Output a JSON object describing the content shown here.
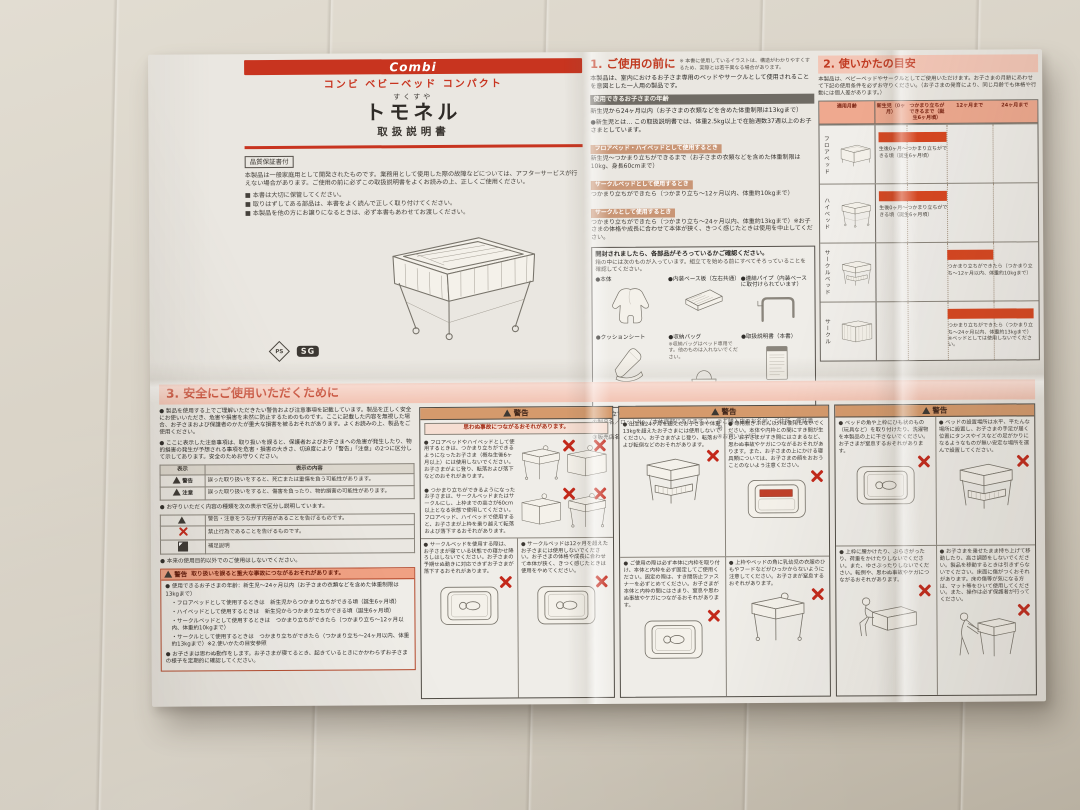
{
  "colors": {
    "brand_red": "#c8341f",
    "header_band_pink": "#f3c6b6",
    "timeline_bar_orange": "#d8451f",
    "warning_band_tan": "#d59a6c",
    "prohibited_x_red": "#c3281a",
    "paper": "#eae7e1",
    "background_sofa": "#cfc8bb"
  },
  "icons": {
    "ps_mark": "PS",
    "sg_mark": "SG",
    "warning_triangle": "△",
    "prohibited_x": "✕",
    "supplement_mark": "■"
  },
  "masthead": {
    "brand": "Combi",
    "product_line": "コンビ ベビーベッド コンパクト",
    "reading": "すくすや",
    "product_name": "トモネル",
    "doc_type": "取扱説明書",
    "warranty_badge": "品質保証書付",
    "intro": "本製品は一般家庭用として開発されたものです。業務用として使用した際の故障などについては、アフターサービスが行えない場合があります。ご使用の前に必ずこの取扱説明書をよくお読みの上、正しくご使用ください。",
    "notes": [
      "■ 本書は大切に保管してください。",
      "■ 取りはずしてある部品は、本書をよく読んで正しく取り付けてください。",
      "■ 本製品を他の方にお譲りになるときは、必ず本書もあわせてお渡しください。"
    ],
    "marks": {
      "ps": "PS",
      "sg": "SG"
    }
  },
  "section1": {
    "title": "1. ご使用の前に",
    "title_note": "※ 本書に使用しているイラストは、構造がわかりやすくするため、実際とは若干異なる場合があります。",
    "intro": "本製品は、室内におけるお子さま専用のベッドやサークルとして使用されることを意図とした一人用の製品です。",
    "age_heading": "使用できるお子さまの年齢",
    "age_line1": "新生児から24ヶ月以内（お子さまの衣類などを含めた体重制限は13kgまで）",
    "age_line2": "●新生児とは… この取扱説明書では、体重2.5kg以上で在胎週数37週以上のお子さまとしています。",
    "modes": [
      {
        "band": "フロアベッド・ハイベッドとして使用するとき",
        "text": "新生児～つかまり立ちができるまで（お子さまの衣類などを含めた体重制限は10kg、身長60cmまで）"
      },
      {
        "band": "サークルベッドとして使用するとき",
        "text": "つかまり立ちができたら（つかまり立ち～12ヶ月以内、体重約10kgまで）"
      },
      {
        "band": "サークルとして使用するとき",
        "text": "つかまり立ちができたら（つかまり立ち～24ヶ月以内、体重約13kgまで）※お子さまの体格や成長に合わせて本体が狭く、きつく感じたときは使用を中止してください。"
      }
    ],
    "parts_box": {
      "title": "開封されましたら、各部品がそろっているかご確認ください。",
      "subtitle": "箱の中には次のものが入っています。組立てを始める前にすべてそろっていることを確認してください。",
      "parts": [
        {
          "name": "●本体"
        },
        {
          "name": "●内装ベース板（左右共通）"
        },
        {
          "name": "●連結パイプ（内装ベースに取付けられています）"
        },
        {
          "name": "●クッションシート"
        },
        {
          "name": "●収納バッグ",
          "note": "※収納バッグはベッド専用です。他のものは入れないでください。"
        },
        {
          "name": "●取扱説明書（本書）"
        }
      ]
    },
    "warranty_note": "● 組み立てる前に、「品質保証書」に次の項目を記入してください。",
    "warranty_items": [
      "①製品名／ロットNo.（本体底部にあります。）",
      "②ご購入店のお名前・ご住所・電話番号",
      "③販売店名",
      "④お買い上げ日"
    ]
  },
  "section2": {
    "title": "2. 使いかたの目安",
    "intro": "本製品は、ベビーベッドやサークルとしてご使用いただけます。お子さまの月齢にあわせて下記の使用条件を必ずお守りください。（お子さまの発育により、同じ月齢でも体格や行動には個人差があります。）",
    "table": {
      "label_header": "適用月齢",
      "columns": [
        "新生児（0ヶ月）",
        "つかまり立ちができるまで（誕生6ヶ月頃）",
        "12ヶ月まで",
        "24ヶ月まで"
      ],
      "rows": [
        {
          "mode": "フロアベッド",
          "range": "生後0ヶ月～つかまり立ちができる頃（誕生6ヶ月頃）"
        },
        {
          "mode": "ハイベッド",
          "range": "生後0ヶ月～つかまり立ちができる頃（誕生6ヶ月頃）"
        },
        {
          "mode": "サークルベッド",
          "range": "つかまり立ちができたら（つかまり立ち～12ヶ月以内、体重約10kgまで）"
        },
        {
          "mode": "サークル",
          "range": "つかまり立ちができたら（つかまり立ち～24ヶ月以内、体重約13kgまで）※ベッドとしては使用しないでください。"
        }
      ]
    }
  },
  "section3": {
    "title": "3. 安全にご使用いただくために",
    "intro1": "● 製品を使用する上でご理解いただきたい警告および注意事項を記載しています。製品を正しく安全にお使いいただき、危害や損害を未然に防止するためのものです。ここに記載した内容を無視した場合、お子さまおよび保護者のかたが重大な損害を被るおそれがあります。よくお読みの上、製品をご使用ください。",
    "intro2": "● ここに表示した注意事項は、取り扱いを誤ると、保護者およびお子さまへの危害が発生したり、物的損害の発生が予想される事項を危害・損害の大きさ、切迫度により「警告」「注意」の2つに区分して示してあります。安全のためお守りください。",
    "label_table": {
      "col1": "表示",
      "col2": "表示の内容",
      "rows": [
        {
          "label": "警告",
          "text": "誤った取り扱いをすると、死亡または重傷を負う可能性があります。"
        },
        {
          "label": "注意",
          "text": "誤った取り扱いをすると、傷害を負ったり、物的損害の可能性があります。"
        }
      ]
    },
    "symbol_note": "● お守りいただく内容の種類を次の表示で区分し説明しています。",
    "symbols": [
      {
        "text": "警告・注意をうながす内容があることを告げるものです。"
      },
      {
        "text": "禁止行為であることを告げるものです。"
      },
      {
        "text": "補足説明"
      }
    ],
    "purpose_note": "● 本来の使用目的以外でのご使用はしないでください。",
    "warn_box": {
      "label": "警告",
      "head": "取り扱いを誤ると重大な事故につながるおそれがあります。",
      "item1": "● 使用できるお子さまの年齢：新生児～24ヶ月以内（お子さまの衣類などを含めた体重制限は13kgまで）",
      "sub": [
        "・フロアベッドとして使用するときは　新生児からつかまり立ちができる頃（誕生6ヶ月頃）",
        "・ハイベッドとして使用するときは　新生児からつかまり立ちができる頃（誕生6ヶ月頃）",
        "・サークルベッドとして使用するときは　つかまり立ちができたら（つかまり立ち～12ヶ月以内、体重約10kgまで）",
        "・サークルとして使用するときは　つかまり立ちができたら（つかまり立ち～24ヶ月以内、体重約13kgまで）※2.使いかたの目安参照"
      ],
      "item2": "● お子さまは思わぬ動作をします。お子さまが寝てるとき、起きているときにかかわらずお子さまの様子を定期的に確認してください。"
    },
    "panelA": {
      "label": "警告",
      "subhead": "思わぬ事故につながるおそれがあります。",
      "item1": "● フロアベッドやハイベッドとして使用するときは、つかまり立ちができるようになったお子さま（概ね生後6ヶ月以上）には使用しないでください。お子さまがよじ登り、転落および落下などのおそれがあります。",
      "item2": "● つかまり立ちができるようになったお子さまは、サークルベッドまたはサークルにし、上枠までの高さが60cm以上となる状態で使用してください。フロアベッド、ハイベッドで使用すると、お子さまが上枠を乗り越えて転落および落下するおそれがあります。",
      "item3": "● サークルベッドを使用する際は、お子さまが寝ている状態での寝かせ降ろしはしないでください。お子さまの予期せぬ動きに対応できずお子さまが落下するおそれがあります。",
      "item4": "● サークルベッドは12ヶ月を超えたお子さまには使用しないでください。お子さまの体格や成長に合わせて本体が狭く、きつく感じたときは使用をやめてください。"
    },
    "panelB": {
      "label": "警告",
      "item1": "● 出生後24ヶ月を超えたお子さまや体重13kgを超えたお子さまには使用しないでください。お子さまがよじ登り、転落および転倒などのおそれがあります。",
      "item2": "● 専用敷きふとん以外は使用しないでください。本体や内枠との間にすき間が生じ、お子さまがすき間にはさまるなど、思わぬ事故やケガにつながるおそれがあります。また、お子さまの上にかける寝具類については、お子さまの顔をおおうことのないよう注意ください。",
      "item3": "● ご使用の際は必ず本体に内枠を取り付け、本体と内枠を必ず固定してご使用ください。固定の際は、すき間防止ファスナーを必ずとめてください。お子さまが本体と内枠の間にはさまり、窒息や思わぬ事故やケガにつながるおそれがあります。",
      "item4": "● 上枠やベッドの角に乳幼児の衣服のひもやフードなどがひっかからないように注意してください。お子さまが窒息するおそれがあります。"
    },
    "panelC": {
      "label": "警告",
      "item1": "● ベッドの角や上枠にひも状のもの（玩具など）を取り付けたり、洗濯物を本製品の上に干さないでください。お子さまが窒息するおそれがあります。",
      "item2": "● ベッドの設置場所は水平、平たんな場所に設置し、お子さまの手足が届く位置にタンスやイスなどの足がかりになるようなものが無い安定な場所を選んで設置してください。",
      "item3": "● 上枠に腰かけたり、ぶらさがったり、荷重をかけたりしないでください。また、ゆさぶったりしないでください。転倒や、思わぬ事故やケガにつながるおそれがあります。",
      "item4": "● お子さまを乗せたまま持ち上げて移動したり、高さ調節をしないでください。製品を移動するときは引きずらないでください。床面に傷がつくおそれがあります。床の傷等が気になる方は、マット等をひいて使用してください。また、操作は必ず保護者が行ってください。"
    }
  }
}
